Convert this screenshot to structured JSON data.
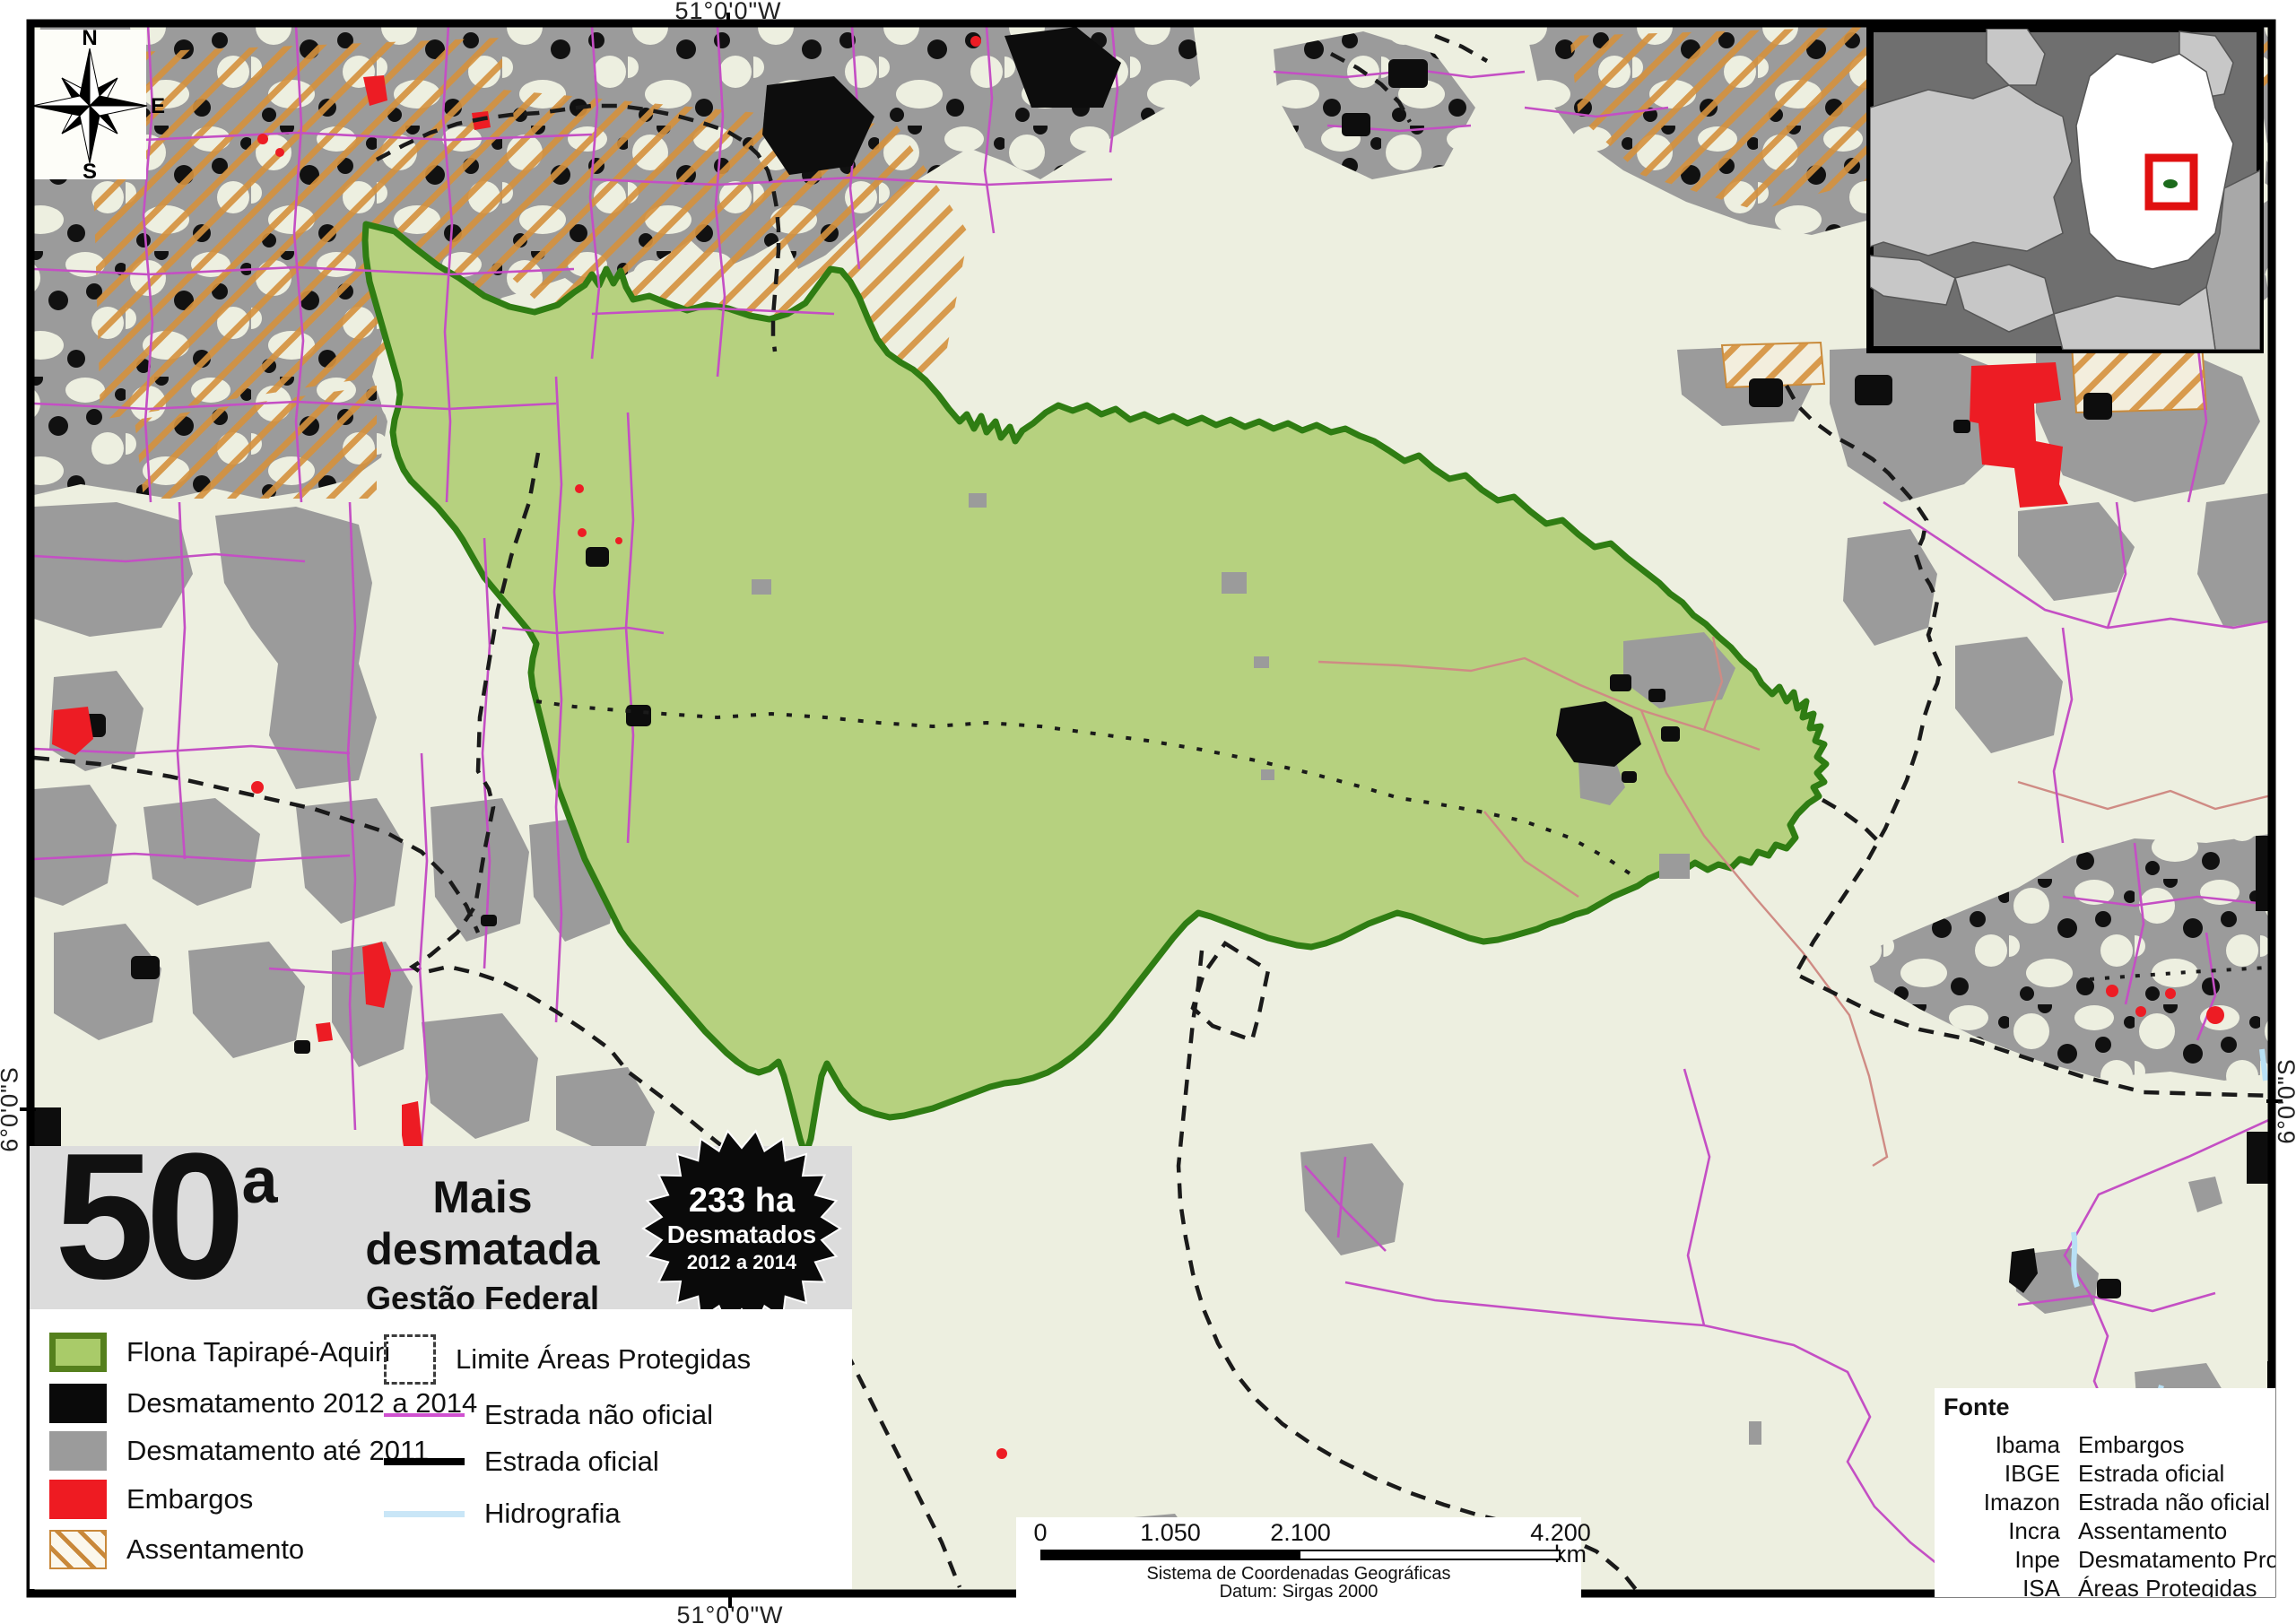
{
  "map_frame": {
    "coordinate_labels": {
      "top": "51°0'0\"W",
      "bottom": "51°0'0\"W",
      "left": "6°0'0\"S",
      "right": "6°0'0\"S"
    },
    "compass": {
      "north": "N",
      "south": "S",
      "east": "E",
      "west": "W"
    }
  },
  "title_box": {
    "rank_number": "50",
    "rank_ordinal": "a",
    "title": "Mais desmatada",
    "subtitle": "Gestão Federal",
    "badge": {
      "line1": "233 ha",
      "line2": "Desmatados",
      "line3": "2012 a 2014"
    }
  },
  "legend": {
    "left": [
      {
        "label": "Flona Tapirapé-Aquiri",
        "type": "flona"
      },
      {
        "label": "Desmatamento 2012 a 2014",
        "type": "desmatamento-2012-2014"
      },
      {
        "label": "Desmatamento até 2011",
        "type": "desmatamento-ate-2011"
      },
      {
        "label": "Embargos",
        "type": "embargos"
      },
      {
        "label": "Assentamento",
        "type": "assentamento"
      }
    ],
    "right": [
      {
        "label": "Limite Áreas Protegidas",
        "type": "limite-areas-protegidas"
      },
      {
        "label": "Estrada não oficial",
        "type": "estrada-nao-oficial"
      },
      {
        "label": "Estrada oficial",
        "type": "estrada-oficial"
      },
      {
        "label": "Hidrografia",
        "type": "hidrografia"
      }
    ]
  },
  "scale_bar": {
    "ticks": [
      "0",
      "1.050",
      "2.100",
      "4.200"
    ],
    "unit": "km",
    "crs": "Sistema de Coordenadas Geográficas",
    "datum": "Datum: Sirgas 2000"
  },
  "fonte": {
    "header": "Fonte",
    "rows": [
      {
        "source": "Ibama",
        "layer": "Embargos"
      },
      {
        "source": "IBGE",
        "layer": "Estrada oficial"
      },
      {
        "source": "Imazon",
        "layer": "Estrada não oficial"
      },
      {
        "source": "Incra",
        "layer": "Assentamento"
      },
      {
        "source": "Inpe",
        "layer": "Desmatamento Prodes"
      },
      {
        "source": "ISA",
        "layer": "Áreas Protegidas"
      }
    ]
  },
  "colors": {
    "map_background": "#edefe0",
    "flona_fill": "#b6d17f",
    "flona_border": "#2f7d13",
    "desmatamento_recente": "#0d0d0d",
    "desmatamento_antigo": "#9b9b9b",
    "embargos": "#ed1c24",
    "assentamento_hatch": "#d5913d",
    "estrada_nao_oficial": "#c44fc4",
    "estrada_oficial": "#000000",
    "hidrografia": "#b8e0f5",
    "title_box_background": "#dcdcdc"
  }
}
